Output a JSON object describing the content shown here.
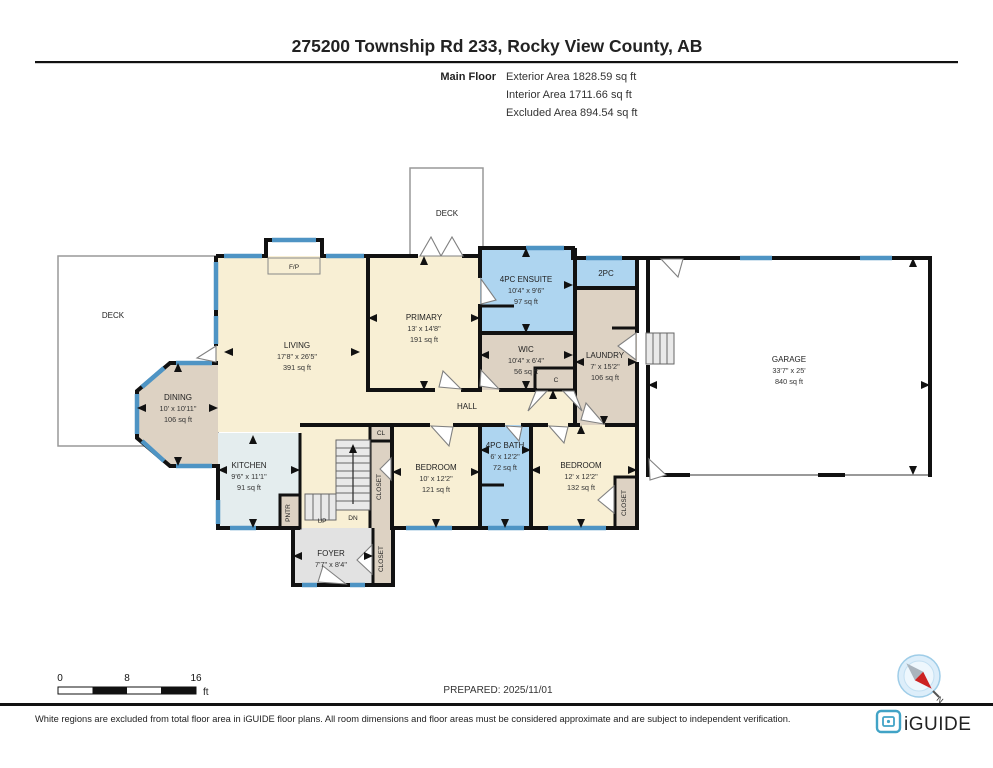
{
  "header": {
    "title": "275200 Township Rd 233, Rocky View County, AB",
    "floor_label": "Main Floor",
    "areas": [
      "Exterior Area 1828.59 sq ft",
      "Interior Area 1711.66 sq ft",
      "Excluded Area 894.54 sq ft"
    ]
  },
  "rooms": {
    "deck_left": {
      "name": "DECK"
    },
    "deck_top": {
      "name": "DECK"
    },
    "living": {
      "name": "LIVING",
      "dims": "17'8\" x 26'5\"",
      "area": "391 sq ft"
    },
    "dining": {
      "name": "DINING",
      "dims": "10' x 10'11\"",
      "area": "106 sq ft"
    },
    "kitchen": {
      "name": "KITCHEN",
      "dims": "9'6\" x 11'1\"",
      "area": "91 sq ft"
    },
    "primary": {
      "name": "PRIMARY",
      "dims": "13' x 14'8\"",
      "area": "191 sq ft"
    },
    "ensuite": {
      "name": "4PC ENSUITE",
      "dims": "10'4\" x 9'6\"",
      "area": "97 sq ft"
    },
    "two_pc": {
      "name": "2PC"
    },
    "wic": {
      "name": "WIC",
      "dims": "10'4\" x 6'4\"",
      "area": "56 sq ft"
    },
    "laundry": {
      "name": "LAUNDRY",
      "dims": "7' x 15'2\"",
      "area": "106 sq ft"
    },
    "garage": {
      "name": "GARAGE",
      "dims": "33'7\" x 25'",
      "area": "840 sq ft"
    },
    "hall": {
      "name": "HALL"
    },
    "bedroom_left": {
      "name": "BEDROOM",
      "dims": "10' x 12'2\"",
      "area": "121 sq ft"
    },
    "bath": {
      "name": "4PC BATH",
      "dims": "6' x 12'2\"",
      "area": "72 sq ft"
    },
    "bedroom_right": {
      "name": "BEDROOM",
      "dims": "12' x 12'2\"",
      "area": "132 sq ft"
    },
    "foyer": {
      "name": "FOYER",
      "dims": "7'7\" x 8'4\""
    },
    "fireplace": {
      "name": "F/P"
    },
    "closet_c": {
      "name": "C"
    },
    "closet_cl": {
      "name": "CL"
    },
    "closet_stairs": {
      "name": "CLOSET"
    },
    "closet_foyer": {
      "name": "CLOSET"
    },
    "closet_bedroom": {
      "name": "CLOSET"
    },
    "pantry": {
      "name": "PNTR"
    },
    "stairs": {
      "up": "UP",
      "down": "DN"
    }
  },
  "scale_bar": {
    "ticks": [
      "0",
      "8",
      "16"
    ],
    "unit": "ft"
  },
  "prepared_label": "PREPARED: 2025/11/01",
  "compass": {
    "north_label": "N"
  },
  "footer": {
    "disclaimer": "White regions are excluded from total floor area in iGUIDE floor plans. All room dimensions and floor areas must be considered approximate and are subject to independent verification.",
    "brand": "iGUIDE"
  },
  "colors": {
    "room_cream": "#f8efd4",
    "room_blue": "#aed5f0",
    "room_tan": "#ddd2c3",
    "room_kitchen": "#e4edee",
    "room_gray": "#e2e2e2",
    "wall": "#111111",
    "window": "#4e94c4",
    "brand_teal": "#41a3c6",
    "compass_red": "#cc2222"
  }
}
